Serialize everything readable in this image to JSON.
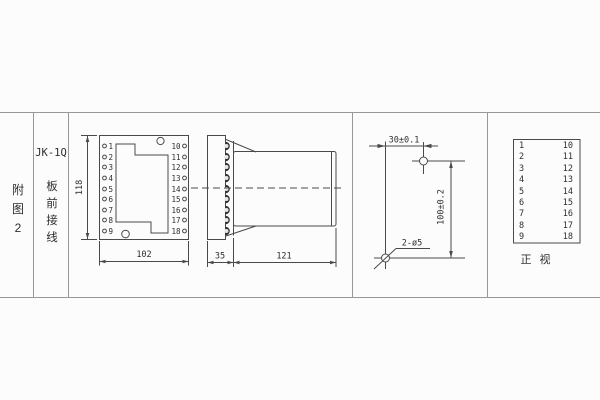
{
  "figure_column": {
    "chars": [
      "附",
      "图",
      "2"
    ]
  },
  "model_column": {
    "model": "JK-1Q",
    "chars": [
      "板",
      "前",
      "接",
      "线"
    ]
  },
  "front_view": {
    "left_terminals": [
      "1",
      "2",
      "3",
      "4",
      "5",
      "6",
      "7",
      "8",
      "9"
    ],
    "right_terminals": [
      "10",
      "11",
      "12",
      "13",
      "14",
      "15",
      "16",
      "17",
      "18"
    ],
    "height_dim": "118",
    "width_dim": "102"
  },
  "side_view": {
    "flange_depth_dim": "35",
    "body_depth_dim": "121"
  },
  "drill_plan": {
    "horizontal_dim": "30±0.1",
    "vertical_dim": "100±0.2",
    "holes_label": "2-ø5"
  },
  "terminal_table": {
    "left_column": [
      "1",
      "2",
      "3",
      "4",
      "5",
      "6",
      "7",
      "8",
      "9"
    ],
    "right_column": [
      "10",
      "11",
      "12",
      "13",
      "14",
      "15",
      "16",
      "17",
      "18"
    ],
    "caption_chars": [
      "正",
      "视"
    ]
  },
  "colors": {
    "line": "#4a4a4a",
    "border": "#989898",
    "text": "#2e2e2e",
    "bump": "#2f2f2f",
    "background": "#fcfcfc"
  }
}
